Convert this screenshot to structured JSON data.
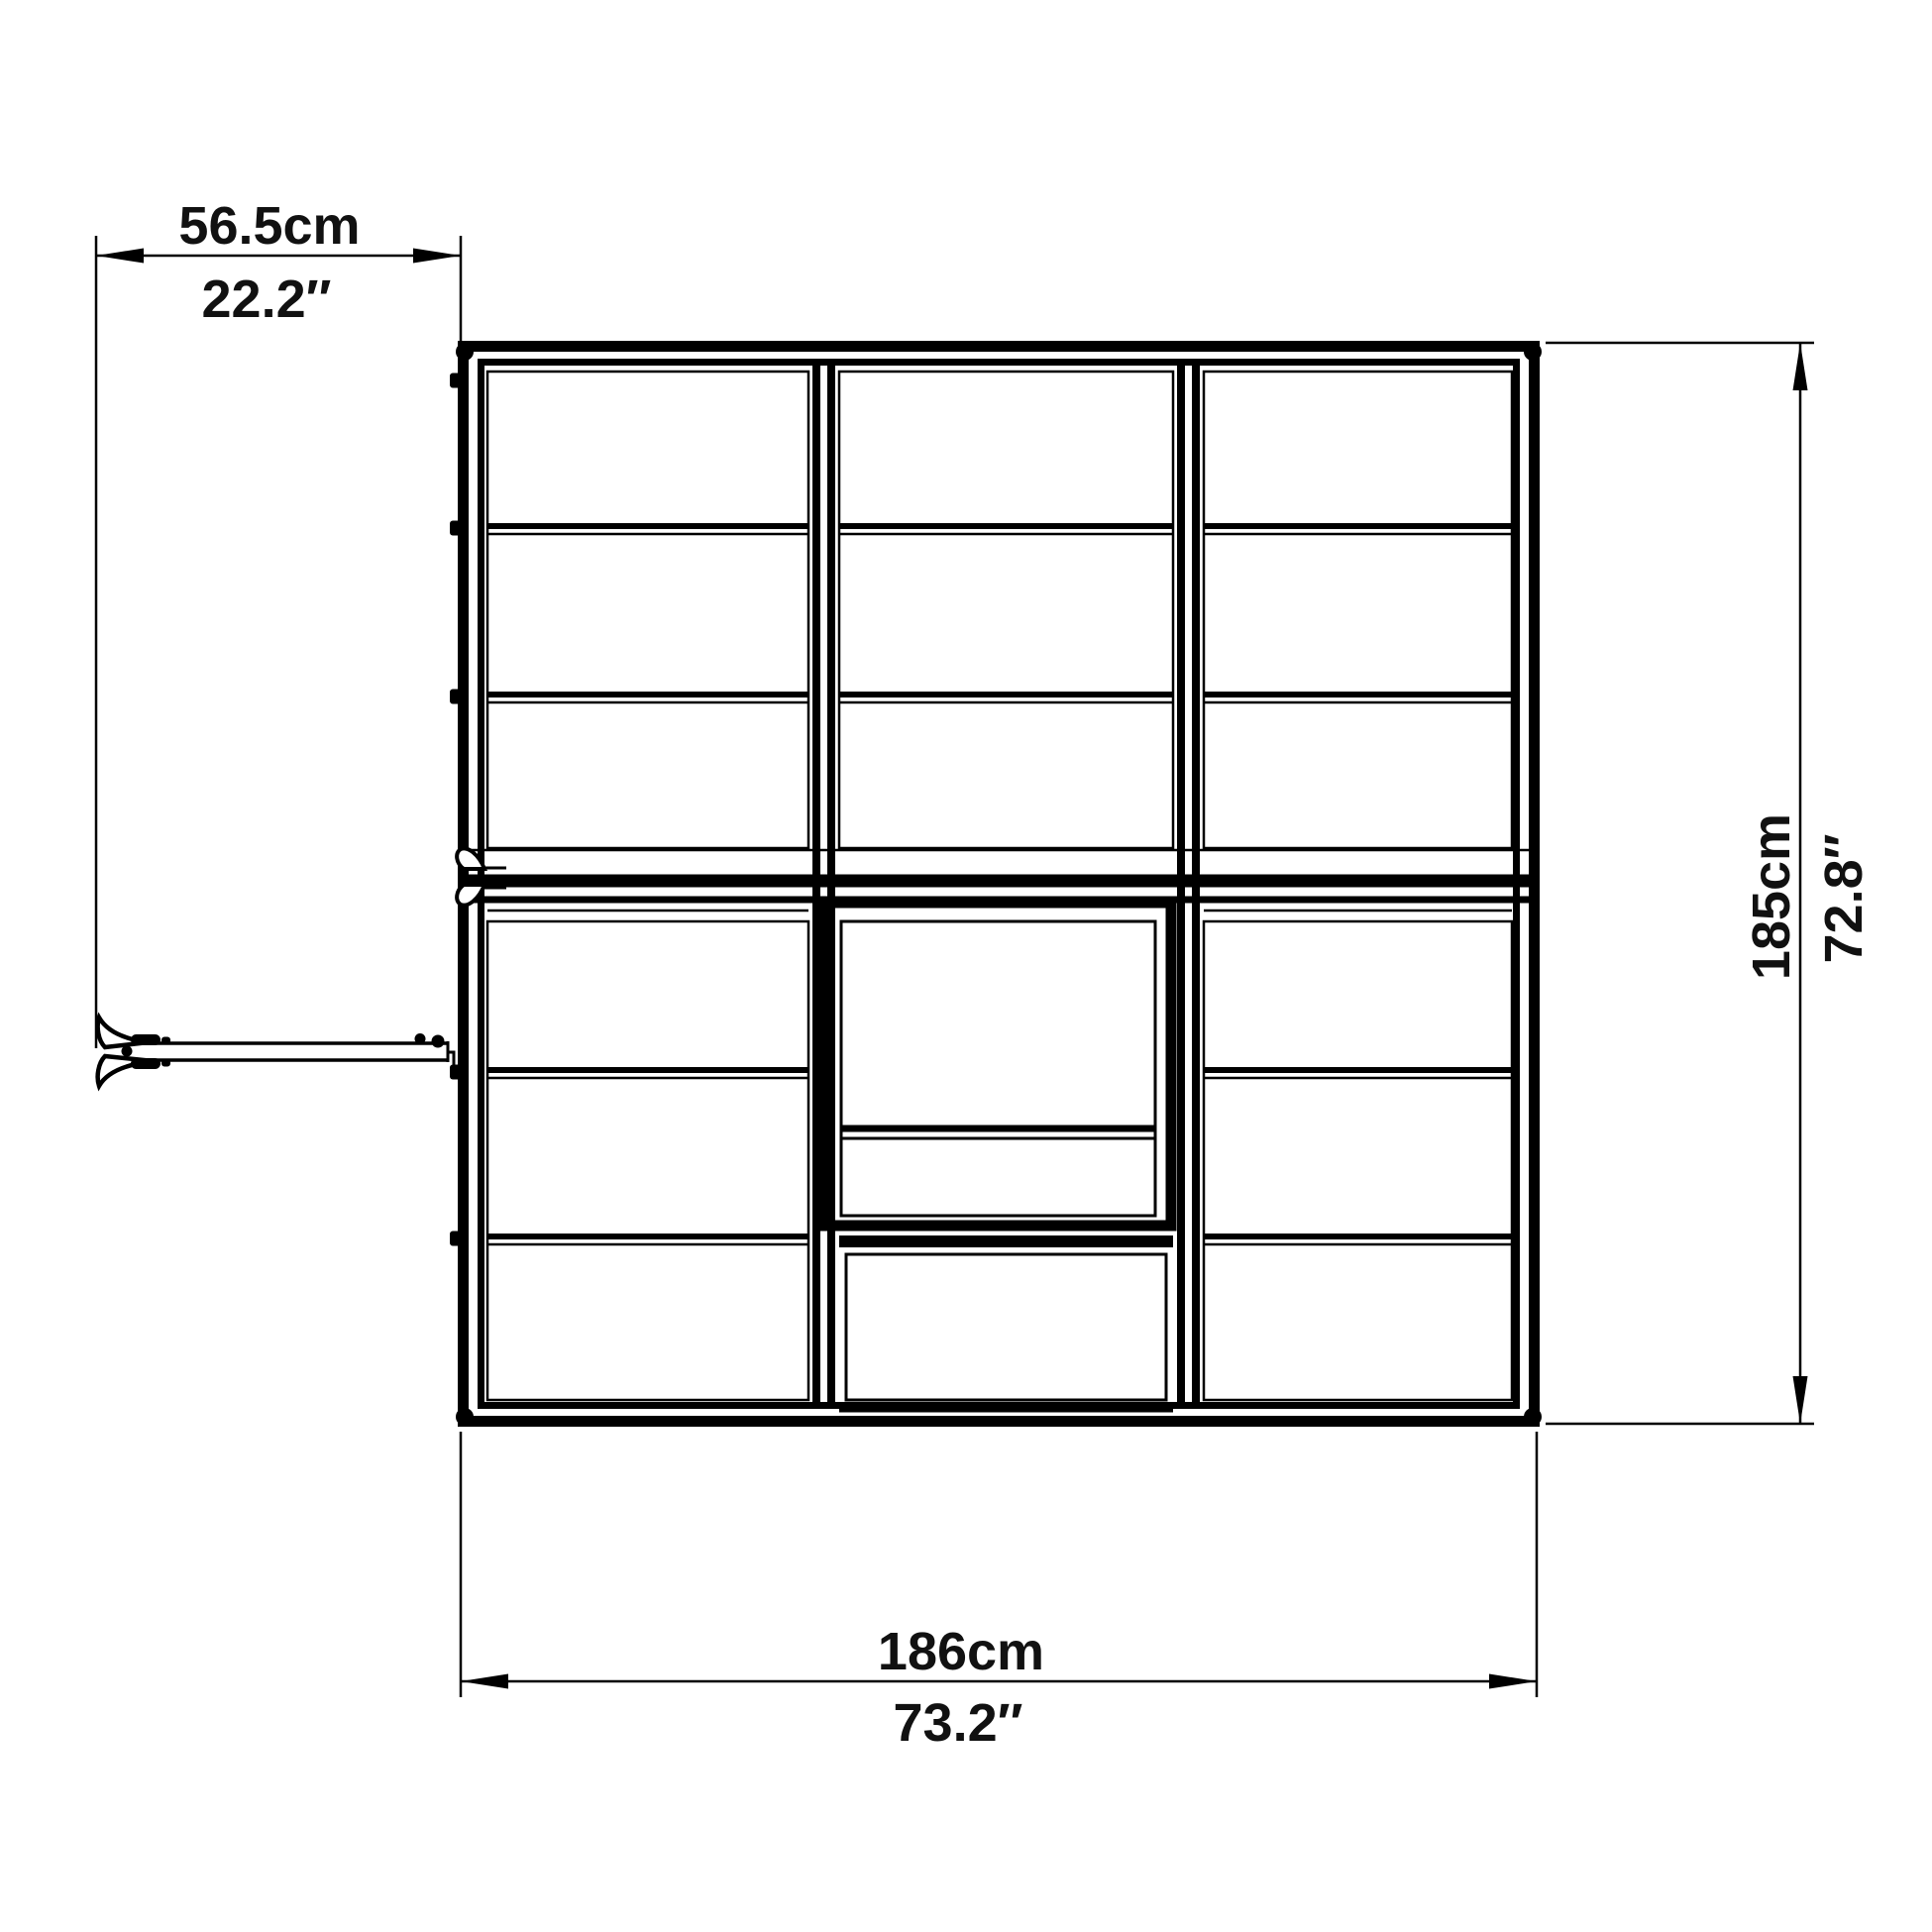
{
  "colors": {
    "line": "#000000",
    "background": "#ffffff"
  },
  "dimensions": {
    "door_width": {
      "metric": "56.5cm",
      "imperial": "22.2″"
    },
    "width": {
      "metric": "186cm",
      "imperial": "73.2″"
    },
    "depth": {
      "metric": "185cm",
      "imperial": "72.8″"
    }
  }
}
